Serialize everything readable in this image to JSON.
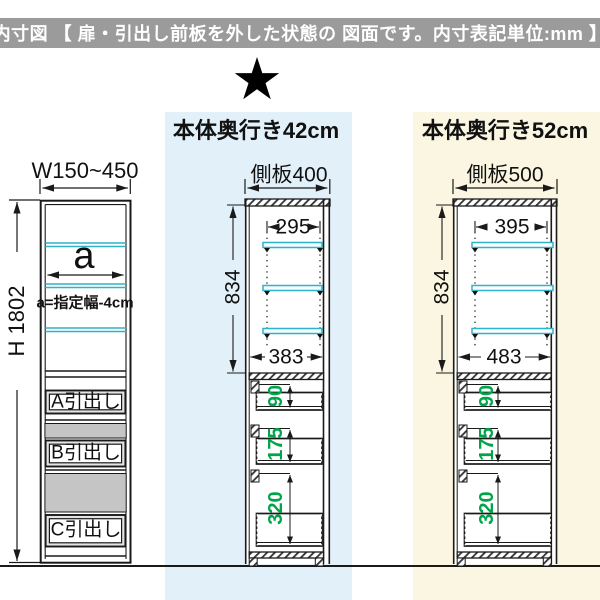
{
  "header": {
    "title": "内寸図 【 扉・引出し前板を外した状態の  図面です。内寸表記単位:mm 】"
  },
  "star_glyph": "★",
  "front_view": {
    "width_label": "W150~450",
    "height_label": "H 1802",
    "shelf_width_label": "a",
    "shelf_width_note": "a=指定幅-4cm",
    "drawer_labels": [
      "A引出し",
      "B引出し",
      "C引出し"
    ]
  },
  "depth42": {
    "heading": "本体奥行き42cm",
    "side_panel_label": "側板400",
    "shelf_width": "295",
    "inner_height": "834",
    "inner_depth": "383",
    "drawer_inner_heights": [
      "90",
      "175",
      "320"
    ]
  },
  "depth52": {
    "heading": "本体奥行き52cm",
    "side_panel_label": "側板500",
    "shelf_width": "395",
    "inner_height": "834",
    "inner_depth": "483",
    "drawer_inner_heights": [
      "90",
      "175",
      "320"
    ]
  },
  "colors": {
    "header_bg": "#9b9b9b",
    "panel_blue": "#e2f1f9",
    "panel_cream": "#faf6e1",
    "shelf_cyan": "#2fb3c8",
    "dimension_green": "#00a44a",
    "line_black": "#1a1a1a",
    "drawer_band_gray": "#c5c5c5"
  }
}
